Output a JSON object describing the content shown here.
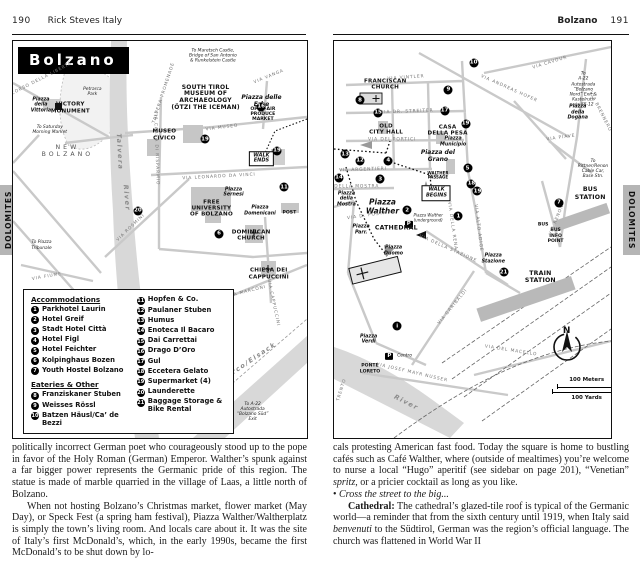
{
  "page_left": {
    "header": {
      "page_number": "190",
      "title": "Rick Steves Italy"
    },
    "tab": "DOLOMITES",
    "map": {
      "title": "Bolzano",
      "labels": [
        {
          "text": "To Maretsch Castle,\nBridge of San Antonio\n& Runkelstein Castle",
          "x": 68,
          "y": 3.8,
          "kind": "note"
        },
        {
          "text": "SOUTH TIROL\nMUSEUM OF\nARCHAEOLOGY\n(ÖTZI THE ICEMAN)",
          "x": 65.5,
          "y": 14.5,
          "kind": "place",
          "fs": "6px"
        },
        {
          "text": "Piazza delle Erbe",
          "x": 84.5,
          "y": 15.3,
          "kind": "piazza"
        },
        {
          "text": "OPEN-AIR\nPRODUCE MARKET",
          "x": 85,
          "y": 18.6,
          "kind": "place-xs"
        },
        {
          "text": "MUSEO\nCIVICO",
          "x": 51.5,
          "y": 23.8,
          "kind": "place"
        },
        {
          "text": "VIA MUSEO",
          "x": 71,
          "y": 21.8,
          "kind": "street",
          "rot": -7
        },
        {
          "text": "WALK\nENDS",
          "x": 84.5,
          "y": 29.6,
          "kind": "box"
        },
        {
          "text": "VICTORY\nMONUMENT",
          "x": 19.5,
          "y": 16.9,
          "kind": "place"
        },
        {
          "text": "Piazza\ndella\nVittoria",
          "x": 9.5,
          "y": 16.3,
          "kind": "piazza-sm"
        },
        {
          "text": "To Saturday\nMorning Market",
          "x": 12.5,
          "y": 22.5,
          "kind": "note"
        },
        {
          "text": "NEW\nBOLZANO",
          "x": 18.5,
          "y": 27.6,
          "kind": "spaced"
        },
        {
          "text": "Petrarca\nPark",
          "x": 27,
          "y": 12.9,
          "kind": "note"
        },
        {
          "text": "TALVERA PROMENADE",
          "x": 51.5,
          "y": 13,
          "kind": "street",
          "rot": -72
        },
        {
          "text": "CORSO DELLA LIBERTÀ",
          "x": 10,
          "y": 9.5,
          "kind": "street",
          "rot": -27
        },
        {
          "text": "Talvera",
          "x": 36,
          "y": 28,
          "kind": "river",
          "rot": 87
        },
        {
          "text": "River",
          "x": 38.5,
          "y": 39.5,
          "kind": "river",
          "rot": 85
        },
        {
          "text": "VIA CASSA DI RISPARMIO",
          "x": 48.5,
          "y": 27,
          "kind": "street",
          "rot": 88
        },
        {
          "text": "VIA VANGA",
          "x": 87,
          "y": 9,
          "kind": "street",
          "rot": -22
        },
        {
          "text": "VIA LEONARDO DA VINCI",
          "x": 70,
          "y": 34.2,
          "kind": "street",
          "rot": -3
        },
        {
          "text": "Piazza\nSernesi",
          "x": 75,
          "y": 38.2,
          "kind": "piazza-sm"
        },
        {
          "text": "FREE\nUNIVERSITY\nOF BOLZANO",
          "x": 67.5,
          "y": 42.2,
          "kind": "place"
        },
        {
          "text": "Piazza\nDomenicani",
          "x": 84,
          "y": 42.9,
          "kind": "piazza-sm"
        },
        {
          "text": "POST",
          "x": 94,
          "y": 43.2,
          "kind": "place-xs"
        },
        {
          "text": "DOMINICAN\nCHURCH",
          "x": 81,
          "y": 49,
          "kind": "place"
        },
        {
          "text": "CHIESA DEI\nCAPPUCCINI",
          "x": 87,
          "y": 58.8,
          "kind": "place"
        },
        {
          "text": "VIA CAPPUCCINI",
          "x": 88.5,
          "y": 66,
          "kind": "street",
          "rot": 78
        },
        {
          "text": "VIA MARCONI",
          "x": 79.5,
          "y": 63.2,
          "kind": "street",
          "rot": -14
        },
        {
          "text": "To Piazza\nTribunale",
          "x": 9.7,
          "y": 51.5,
          "kind": "note"
        },
        {
          "text": "VIA FIUME",
          "x": 11.5,
          "y": 59.5,
          "kind": "street",
          "rot": -10
        },
        {
          "text": "VIA ROSMINI",
          "x": 40,
          "y": 47,
          "kind": "street",
          "rot": -44
        },
        {
          "text": "Isarco/Eisack",
          "x": 80,
          "y": 81,
          "kind": "river",
          "rot": -34
        },
        {
          "text": "To A-22\nAutostrada\n“Bolzano Süd”\nExit",
          "x": 81.5,
          "y": 93.5,
          "kind": "note"
        }
      ],
      "markers": [
        {
          "n": "16",
          "x": 84.4,
          "y": 16.6
        },
        {
          "n": "19",
          "x": 65.3,
          "y": 24.7
        },
        {
          "n": "19",
          "x": 89.8,
          "y": 27.7
        },
        {
          "n": "11",
          "x": 92.2,
          "y": 36.8
        },
        {
          "n": "6",
          "x": 70.1,
          "y": 48.6
        },
        {
          "n": "20",
          "x": 42.5,
          "y": 42.8
        }
      ],
      "legend": {
        "accommodations_title": "Accommodations",
        "accommodations": [
          {
            "n": "1",
            "label": "Parkhotel Laurin"
          },
          {
            "n": "2",
            "label": "Hotel Greif"
          },
          {
            "n": "3",
            "label": "Stadt Hotel Città"
          },
          {
            "n": "4",
            "label": "Hotel Figl"
          },
          {
            "n": "5",
            "label": "Hotel Feichter"
          },
          {
            "n": "6",
            "label": "Kolpinghaus Bozen"
          },
          {
            "n": "7",
            "label": "Youth Hostel Bolzano"
          }
        ],
        "eateries_title": "Eateries & Other",
        "eateries": [
          {
            "n": "8",
            "label": "Franziskaner Stuben"
          },
          {
            "n": "9",
            "label": "Weisses Rössl"
          },
          {
            "n": "10",
            "label": "Batzen Häusl/Ca’ de Bezzi"
          }
        ],
        "other": [
          {
            "n": "11",
            "label": "Hopfen & Co."
          },
          {
            "n": "12",
            "label": "Paulaner Stuben"
          },
          {
            "n": "13",
            "label": "Humus"
          },
          {
            "n": "14",
            "label": "Enoteca Il Bacaro"
          },
          {
            "n": "15",
            "label": "Dai Carrettai"
          },
          {
            "n": "16",
            "label": "Drago D’Oro"
          },
          {
            "n": "17",
            "label": "Gul"
          },
          {
            "n": "18",
            "label": "Eccetera Gelato"
          },
          {
            "n": "19",
            "label": "Supermarket (4)"
          },
          {
            "n": "20",
            "label": "Launderette"
          },
          {
            "n": "21",
            "label": "Baggage Storage & Bike Rental"
          }
        ]
      }
    },
    "body": [
      {
        "indent": false,
        "runs": [
          {
            "t": "politically incorrect German poet who courageously stood up to the pope in favor of the Holy Roman (German) Emperor. Walther’s spunk against a far bigger power represents the Germanic pride of this region. The statue is made of marble quarried in the village of Laas, a little north of Bolzano."
          }
        ]
      },
      {
        "indent": true,
        "runs": [
          {
            "t": "When not hosting Bolzano’s Christmas market, flower market (May Day), or Speck Fest (a spring ham festival), Piazza Walther/Waltherplatz is simply the town’s living room. And locals care about it. It was the site of Italy’s first McDonald’s, which, in the early 1990s, became the first McDonald’s to be shut down by lo-"
          }
        ]
      }
    ]
  },
  "page_right": {
    "header": {
      "title": "Bolzano",
      "page_number": "191"
    },
    "tab": "DOLOMITES",
    "map": {
      "labels": [
        {
          "text": "FRANCISCAN\nCHURCH",
          "x": 18.5,
          "y": 11.1,
          "kind": "place"
        },
        {
          "text": "VIA VINTLER",
          "x": 26,
          "y": 9.3,
          "kind": "street",
          "rot": -4
        },
        {
          "text": "VIA CAVOUR",
          "x": 78,
          "y": 5.5,
          "kind": "street",
          "rot": -17
        },
        {
          "text": "VIA ANDREAS HOFER",
          "x": 63,
          "y": 12,
          "kind": "street",
          "rot": 24
        },
        {
          "text": "To\nA-22 Autostrada\n“Bolzano Nord” Exit &\nKastelruth via SS-12",
          "x": 90,
          "y": 12.2,
          "kind": "note"
        },
        {
          "text": "Piazza\ndella\nDogana",
          "x": 88,
          "y": 18.2,
          "kind": "piazza-sm"
        },
        {
          "text": "VIA BRENNERO",
          "x": 96,
          "y": 18,
          "kind": "street",
          "rot": 63
        },
        {
          "text": "VIA DR. STREITER",
          "x": 26.5,
          "y": 18,
          "kind": "street",
          "rot": -2
        },
        {
          "text": "OLD\nCITY HALL",
          "x": 18.8,
          "y": 22.3,
          "kind": "place"
        },
        {
          "text": "CASA\nDELLA PESA",
          "x": 41,
          "y": 22.6,
          "kind": "place"
        },
        {
          "text": "VIA DEI PORTICI",
          "x": 21,
          "y": 24.9,
          "kind": "street"
        },
        {
          "text": "Piazza\nMunicipio",
          "x": 43,
          "y": 25.5,
          "kind": "piazza-sm"
        },
        {
          "text": "Piazza del\nGrano",
          "x": 37.5,
          "y": 29.3,
          "kind": "piazza"
        },
        {
          "text": "VIA ARGENTIERI",
          "x": 10.5,
          "y": 32.4,
          "kind": "street",
          "rot": -2
        },
        {
          "text": "WALTHER\nPASSAGE",
          "x": 37.5,
          "y": 33.9,
          "kind": "place-xs",
          "fs": "4px"
        },
        {
          "text": "VIA DELLA MOSTRA",
          "x": 6,
          "y": 36.7,
          "kind": "street"
        },
        {
          "text": "Piazza\ndella\nMostra",
          "x": 4.5,
          "y": 40,
          "kind": "piazza-sm"
        },
        {
          "text": "Piazza\nWalther",
          "x": 17.5,
          "y": 41.8,
          "kind": "piazza-lg"
        },
        {
          "text": "WALK\nBEGINS",
          "x": 37,
          "y": 38.4,
          "kind": "box"
        },
        {
          "text": "Piazza Walther\n(underground)",
          "x": 34,
          "y": 44.7,
          "kind": "note",
          "fs": "4px"
        },
        {
          "text": "P",
          "x": 27,
          "y": 46.2,
          "kind": "pbox"
        },
        {
          "text": "CATHEDRAL",
          "x": 22.5,
          "y": 47,
          "kind": "place",
          "fs": "6.2px"
        },
        {
          "text": "Piazza\nParr.",
          "x": 9.8,
          "y": 47.7,
          "kind": "piazza-sm"
        },
        {
          "text": "Piazza\nDuomo",
          "x": 21.5,
          "y": 53,
          "kind": "piazza-sm"
        },
        {
          "text": "VIA D. POSTA",
          "x": 12,
          "y": 44.2,
          "kind": "street",
          "rot": -8
        },
        {
          "text": "VIA DELLA RENA",
          "x": 42.5,
          "y": 46.5,
          "kind": "street",
          "rot": 82
        },
        {
          "text": "VIA DELLA STAZIONE",
          "x": 41,
          "y": 52.3,
          "kind": "street",
          "rot": 24
        },
        {
          "text": "Piazza\nStazione",
          "x": 57.5,
          "y": 55,
          "kind": "piazza-sm"
        },
        {
          "text": "TRAIN\nSTATION",
          "x": 74.5,
          "y": 59.5,
          "kind": "place",
          "fs": "6.2px"
        },
        {
          "text": "BUS\nINFO\nPOINT",
          "x": 80,
          "y": 49.2,
          "kind": "place-xs"
        },
        {
          "text": "BUS",
          "x": 75.5,
          "y": 46.3,
          "kind": "place-xs"
        },
        {
          "text": "BUS\nSTATION",
          "x": 92.5,
          "y": 38.4,
          "kind": "place",
          "fs": "6.2px"
        },
        {
          "text": "To\nRittner/Renon\nCable Car,\nBase Stn.",
          "x": 93.5,
          "y": 32.2,
          "kind": "note"
        },
        {
          "text": "VIA RENON",
          "x": 80.5,
          "y": 45,
          "kind": "street",
          "rot": -68
        },
        {
          "text": "VIA GARIBALDI",
          "x": 43,
          "y": 67,
          "kind": "street",
          "rot": -51
        },
        {
          "text": "VIA ALTO ADIGE",
          "x": 52,
          "y": 47,
          "kind": "street",
          "rot": 83
        },
        {
          "text": "VIA PIAVE",
          "x": 82,
          "y": 24.5,
          "kind": "street",
          "rot": -8
        },
        {
          "text": "Piazza\nVerdi",
          "x": 12.5,
          "y": 75.2,
          "kind": "piazza-sm"
        },
        {
          "text": "P",
          "x": 20,
          "y": 79.4,
          "kind": "pbox"
        },
        {
          "text": "Centro",
          "x": 25.5,
          "y": 79.4,
          "kind": "note"
        },
        {
          "text": "PONTE\nLORETO",
          "x": 13,
          "y": 82.7,
          "kind": "place-xs"
        },
        {
          "text": "VIA JOSEF MAYR NUSSER",
          "x": 28,
          "y": 83.7,
          "kind": "street",
          "rot": 13
        },
        {
          "text": "River",
          "x": 26,
          "y": 91.3,
          "kind": "river",
          "rot": 27
        },
        {
          "text": "TRENTO",
          "x": 2.8,
          "y": 87.8,
          "kind": "street",
          "rot": -73
        },
        {
          "text": "VIA DEL MACELLO",
          "x": 64,
          "y": 78.2,
          "kind": "street",
          "rot": 9
        }
      ],
      "markers": [
        {
          "n": "10",
          "x": 50.4,
          "y": 5.5
        },
        {
          "n": "9",
          "x": 41.3,
          "y": 12.3
        },
        {
          "n": "8",
          "x": 9.4,
          "y": 14.9
        },
        {
          "n": "15",
          "x": 15.9,
          "y": 18.1
        },
        {
          "n": "17",
          "x": 39.9,
          "y": 17.6
        },
        {
          "n": "19",
          "x": 47.5,
          "y": 20.9
        },
        {
          "n": "13",
          "x": 4,
          "y": 28.5
        },
        {
          "n": "12",
          "x": 9.4,
          "y": 30.2
        },
        {
          "n": "4",
          "x": 19.6,
          "y": 30.2
        },
        {
          "n": "14",
          "x": 1.8,
          "y": 34.5
        },
        {
          "n": "3",
          "x": 16.7,
          "y": 34.8
        },
        {
          "n": "5",
          "x": 48.2,
          "y": 32
        },
        {
          "n": "18",
          "x": 49.6,
          "y": 36
        },
        {
          "n": "19",
          "x": 51.8,
          "y": 37.8
        },
        {
          "n": "2",
          "x": 26.4,
          "y": 42.6
        },
        {
          "n": "1",
          "x": 44.9,
          "y": 44.1
        },
        {
          "n": "7",
          "x": 81.2,
          "y": 40.8
        },
        {
          "n": "21",
          "x": 61.2,
          "y": 58.2
        },
        {
          "n": "i",
          "x": 22.8,
          "y": 71.8
        }
      ],
      "compass": {
        "label": "N"
      },
      "scale": {
        "meters": "100 Meters",
        "yards": "100 Yards"
      }
    },
    "body": [
      {
        "indent": false,
        "runs": [
          {
            "t": "cals protesting American fast food. Today the square is home to bustling cafés such as Café Walther, where (outside of mealtimes) you’re welcome to nurse a local “Hugo” aperitif (see sidebar on page 201), “Venetian” "
          },
          {
            "t": "spritz",
            "s": "i"
          },
          {
            "t": ", or a pricier cocktail as long as you like."
          }
        ]
      },
      {
        "indent": false,
        "runs": [
          {
            "t": "• "
          },
          {
            "t": "Cross the street to the big...",
            "s": "i"
          }
        ]
      },
      {
        "indent": true,
        "runs": [
          {
            "t": "Cathedral:",
            "s": "b"
          },
          {
            "t": " The cathedral’s glazed-tile roof is typical of the Germanic world—a reminder that from the sixth century until 1919, when Italy said "
          },
          {
            "t": "benvenuti",
            "s": "i"
          },
          {
            "t": " to the Südtirol, German was the region’s official language. The church was flattened in World War II"
          }
        ]
      }
    ]
  }
}
